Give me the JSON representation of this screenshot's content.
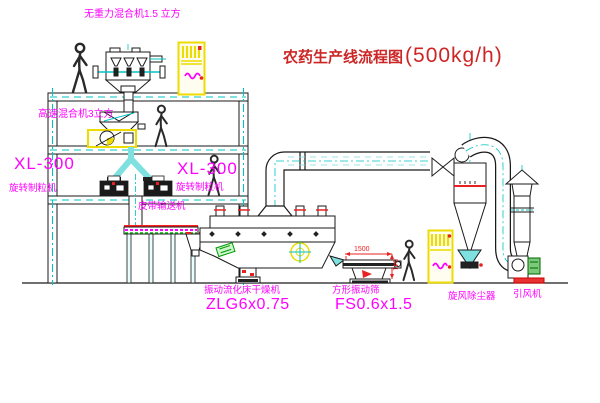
{
  "title": {
    "main": "农药生产线流程图",
    "capacity": "(500kg/h)"
  },
  "labels": {
    "top_mixer": "无重力混合机1.5 立方",
    "highspeed_mixer": "高速混合机3立方",
    "granulator_left_model": "XL-300",
    "granulator_left_name": "旋转制粒机",
    "granulator_mid_model": "XL-300",
    "granulator_mid_name": "旋转制粒机",
    "belt_conveyor": "皮带输送机",
    "dryer_name": "振动流化床干燥机",
    "dryer_model": "ZLG6x0.75",
    "sieve_name": "方形振动筛",
    "sieve_model": "FS0.6x1.5",
    "cyclone": "旋风除尘器",
    "fan": "引风机"
  },
  "dimensions": {
    "sieve_length": "1500",
    "sieve_height": "541"
  },
  "colors": {
    "line": "#1a1a1a",
    "cyan": "#00c3c3",
    "magenta": "#ff00ff",
    "red": "#e82222",
    "title_red": "#cc2626",
    "yellow": "#ecdc00",
    "green": "#009900"
  }
}
